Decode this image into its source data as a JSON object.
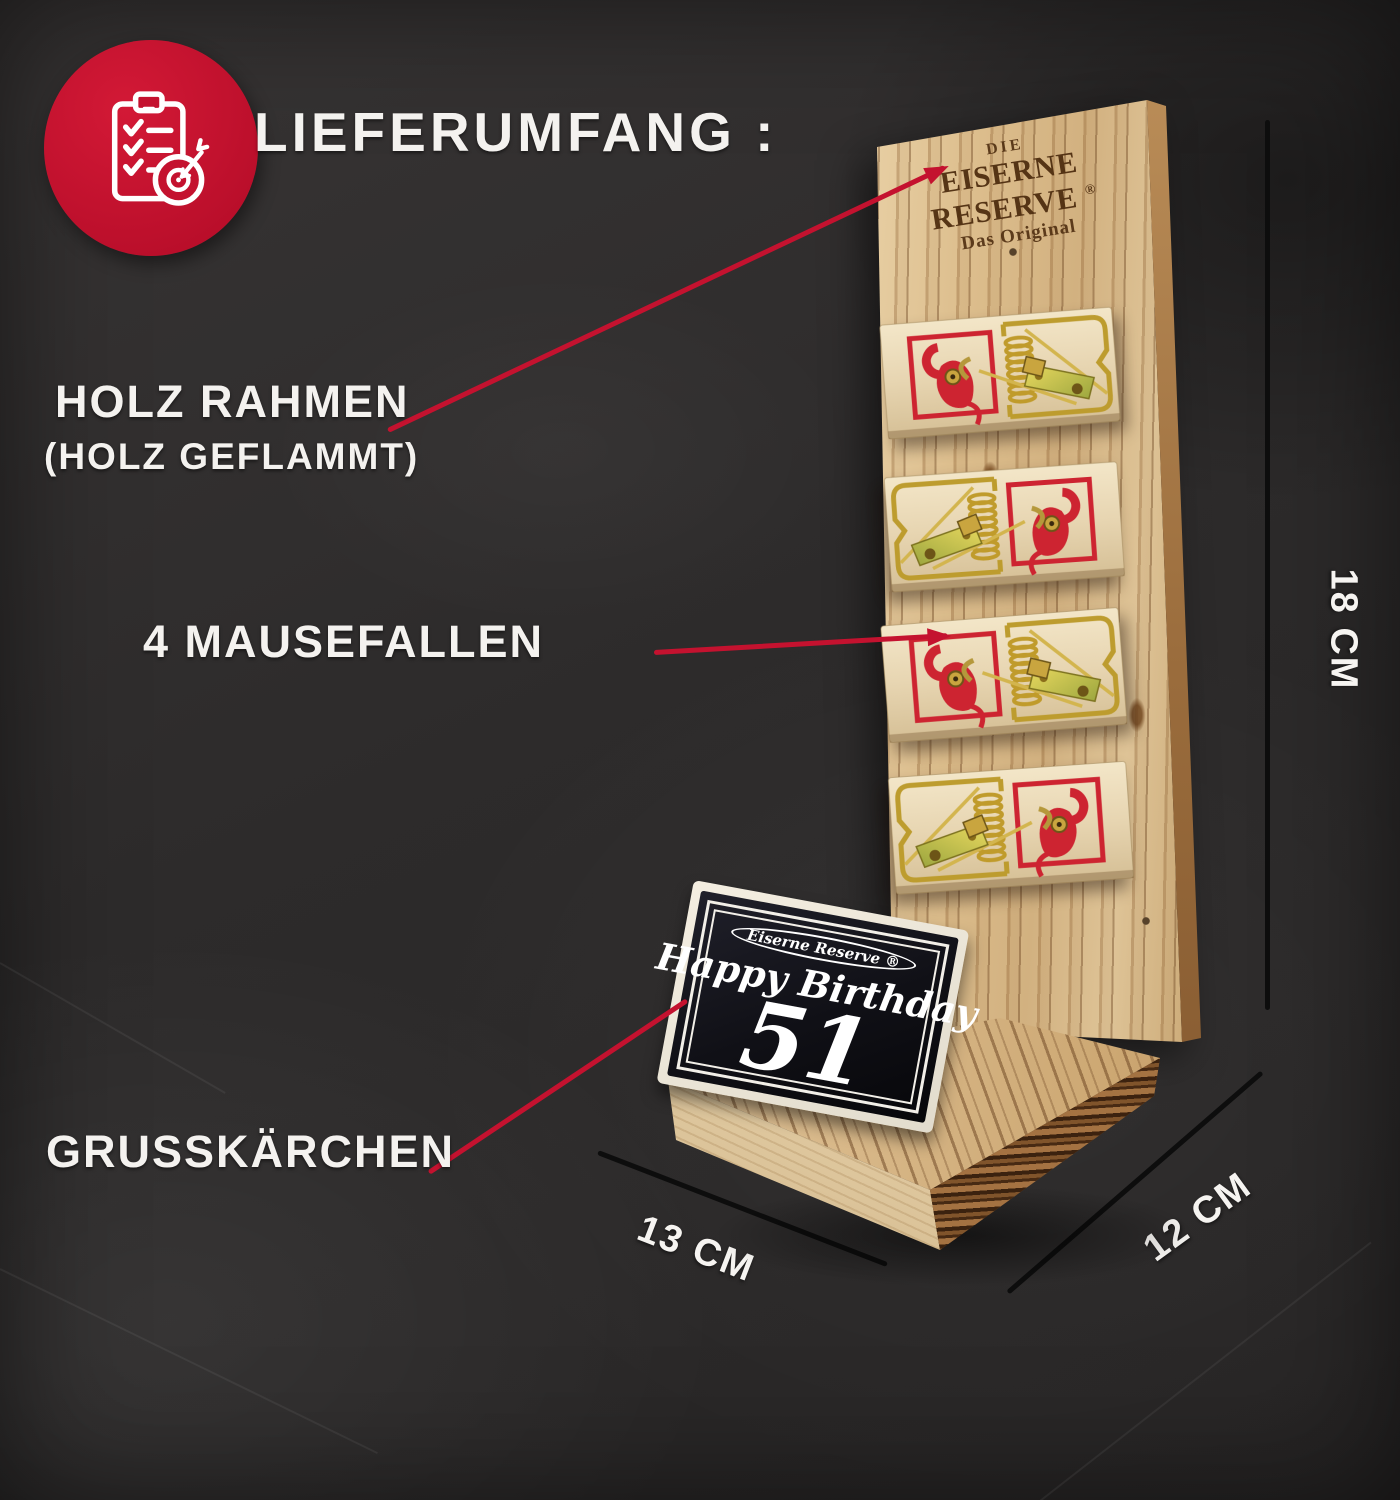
{
  "colors": {
    "accent_red": "#c4122f",
    "dimension_line": "#0d0d0d",
    "label_text": "#f4f2ef",
    "board_wood": "#d9ba8c",
    "card_face": "#101016"
  },
  "header": {
    "title": "LIEFERUMFANG :",
    "badge_icon": "clipboard-checklist-target-icon"
  },
  "callouts": {
    "frame": {
      "label": "HOLZ RAHMEN",
      "sublabel": "(HOLZ GEFLAMMT)"
    },
    "traps": {
      "label": "4 MAUSEFALLEN"
    },
    "card": {
      "label": "GRUSSKÄRCHEN"
    }
  },
  "dimensions": {
    "height_label": "18 CM",
    "width_label": "13 CM",
    "depth_label": "12 CM"
  },
  "product": {
    "board_branding": {
      "line1": "DIE",
      "line2": "EISERNE RESERVE",
      "reg": "®",
      "line3": "Das Original"
    },
    "greeting_card": {
      "brand": "Eiserne Reserve ®",
      "greeting": "Happy Birthday",
      "number": "51"
    },
    "trap_count": 4
  }
}
